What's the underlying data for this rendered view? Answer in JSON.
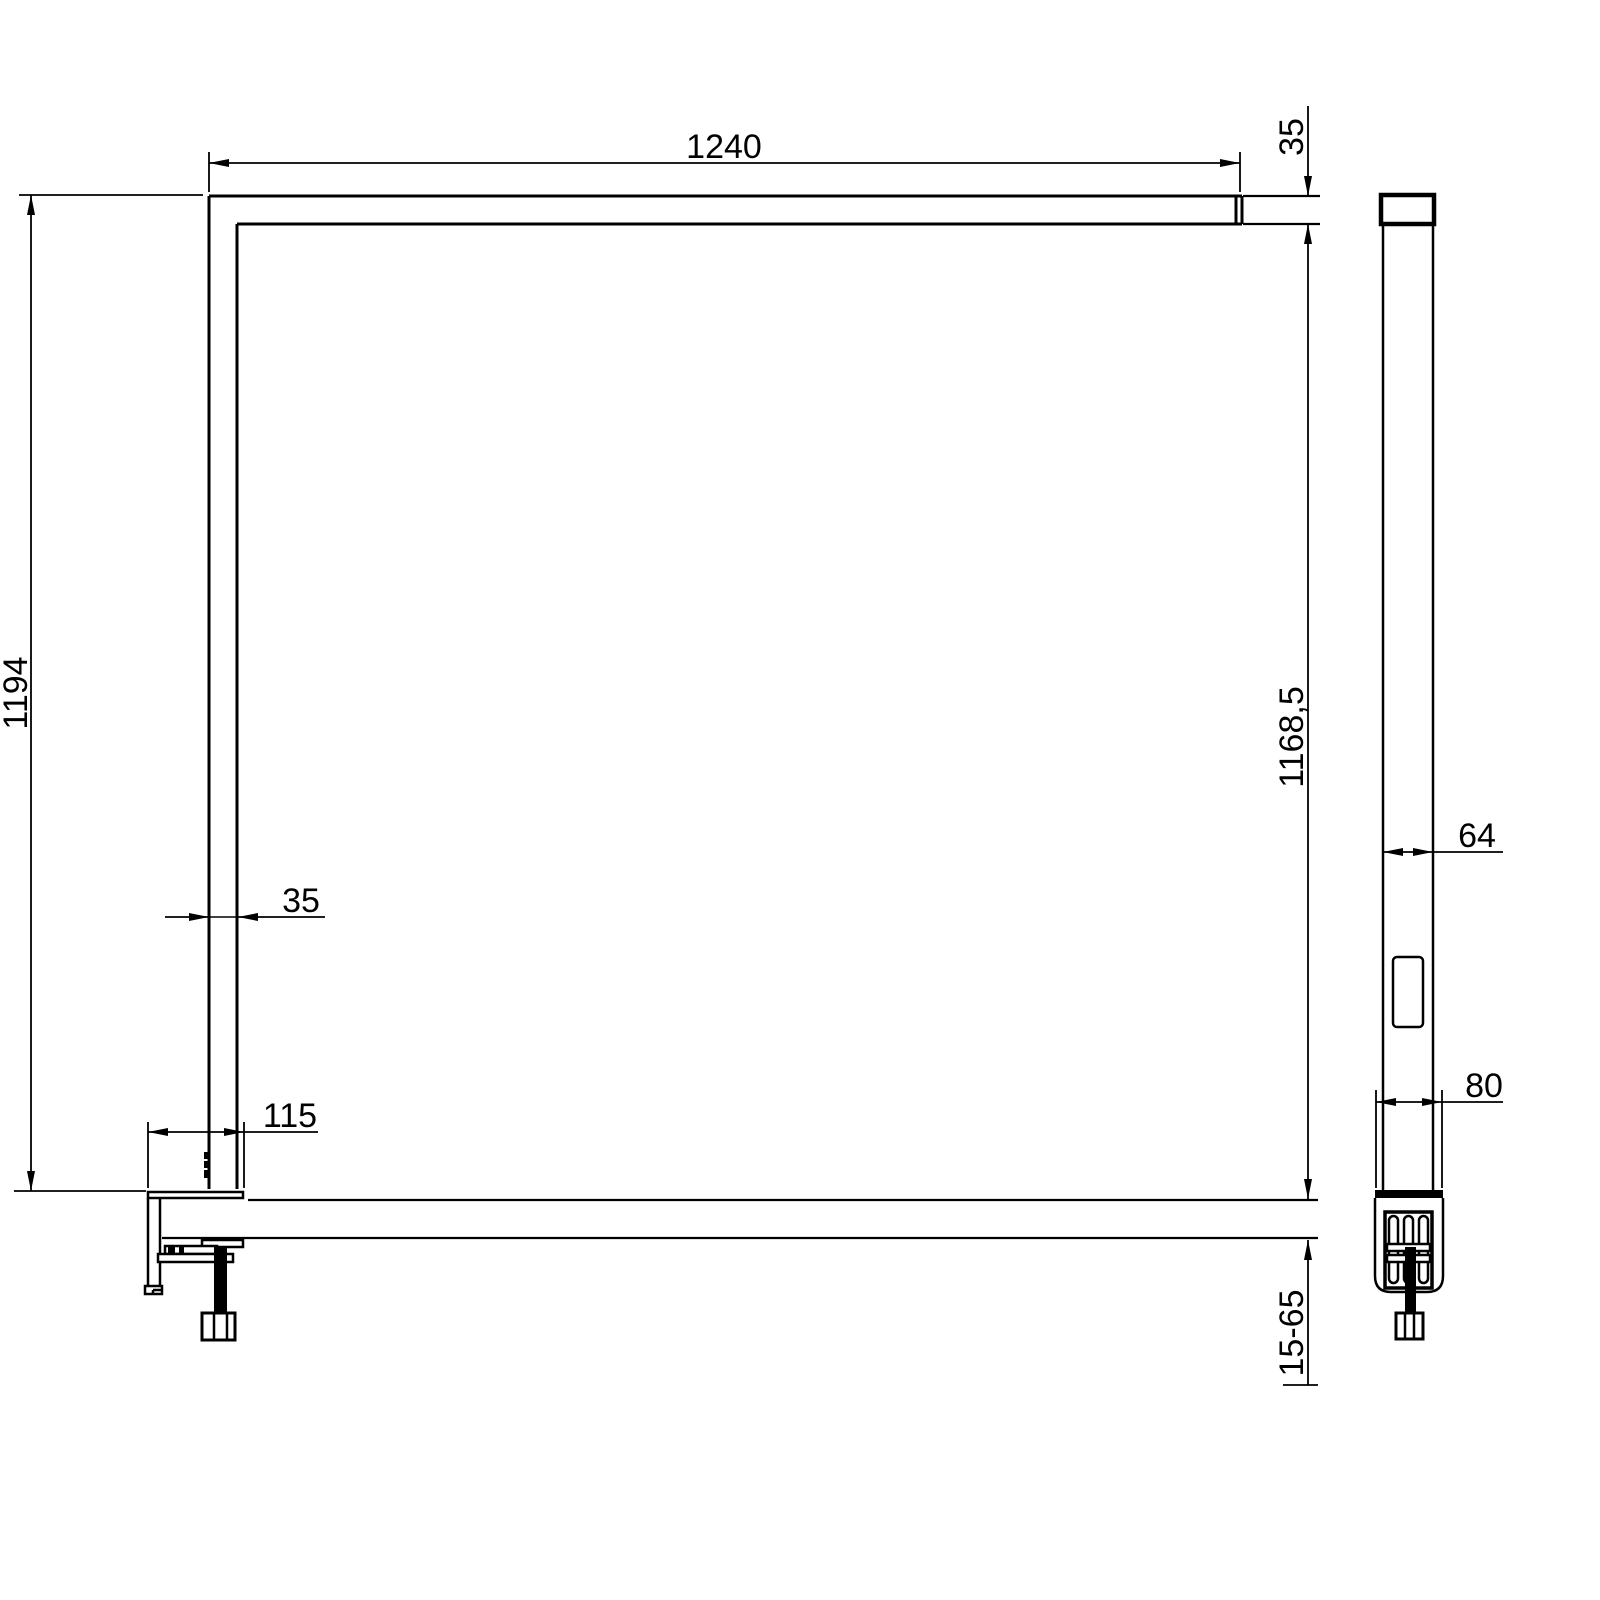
{
  "drawing": {
    "type": "technical-dimension-drawing",
    "description": "Clamp-mounted linear desk lamp, front view and side view with dimensions",
    "colors": {
      "line": "#000000",
      "background": "#ffffff"
    },
    "dimensions": {
      "bar_length": "1240",
      "head_thickness": "35",
      "total_height": "1194",
      "under_bar_height": "1168,5",
      "post_width": "35",
      "clamp_depth": "115",
      "post_depth": "64",
      "clamp_width": "80",
      "clamp_range": "15-65"
    }
  }
}
